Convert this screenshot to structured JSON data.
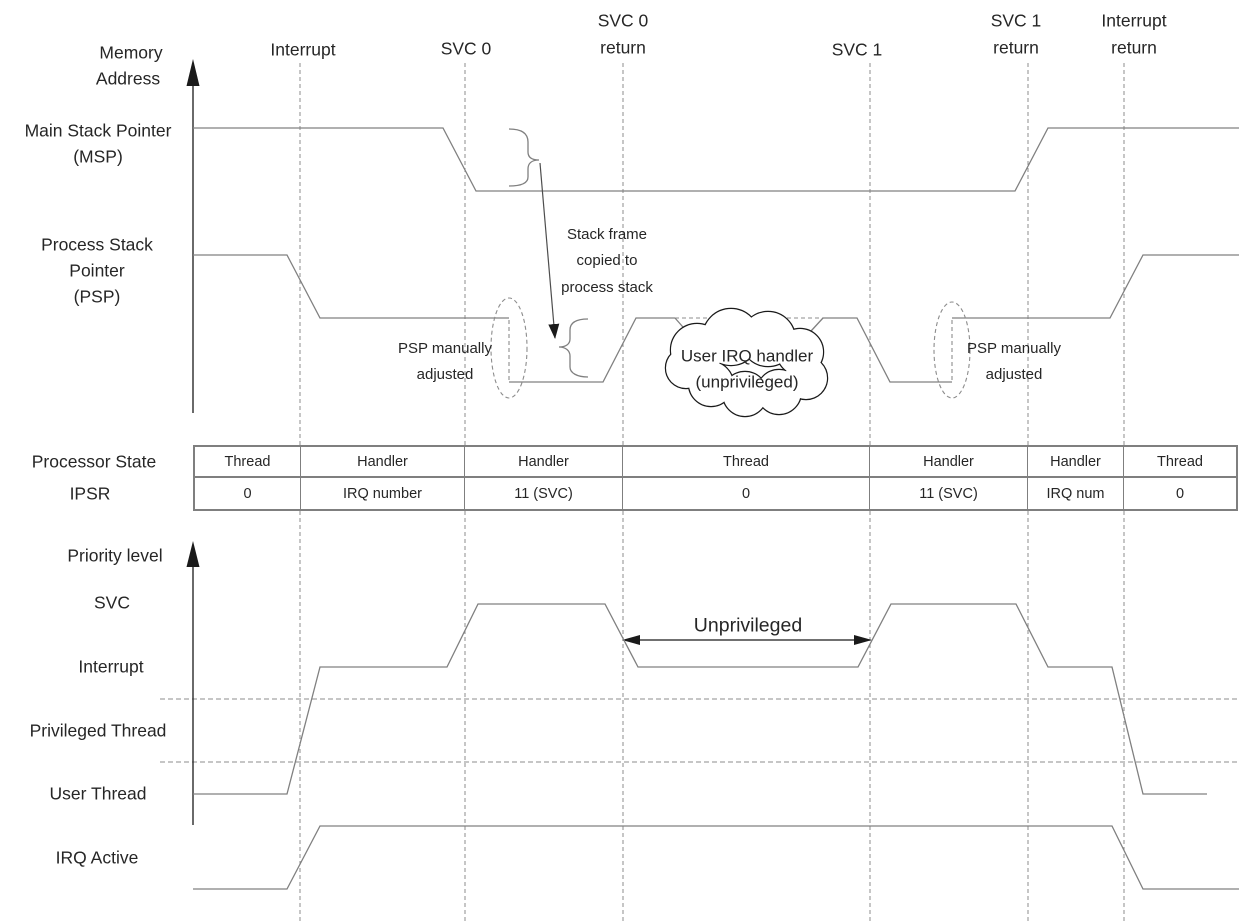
{
  "memory_section": {
    "axis_label_line1": "Memory",
    "axis_label_line2": "Address",
    "msp_label_line1": "Main Stack Pointer",
    "msp_label_line2": "(MSP)",
    "psp_label_line1": "Process Stack",
    "psp_label_line2": "Pointer",
    "psp_label_line3": "(PSP)"
  },
  "events": {
    "interrupt": "Interrupt",
    "svc0": "SVC 0",
    "svc0_return_line1": "SVC 0",
    "svc0_return_line2": "return",
    "svc1": "SVC 1",
    "svc1_return_line1": "SVC 1",
    "svc1_return_line2": "return",
    "interrupt_return_line1": "Interrupt",
    "interrupt_return_line2": "return"
  },
  "annotations": {
    "stack_frame_line1": "Stack frame",
    "stack_frame_line2": "copied to",
    "stack_frame_line3": "process stack",
    "psp_adjusted_left_line1": "PSP manually",
    "psp_adjusted_left_line2": "adjusted",
    "psp_adjusted_right_line1": "PSP manually",
    "psp_adjusted_right_line2": "adjusted",
    "cloud_line1": "User IRQ handler",
    "cloud_line2": "(unprivileged)",
    "unprivileged": "Unprivileged"
  },
  "state_table": {
    "row1_label": "Processor State",
    "row2_label": "IPSR",
    "state_cells": [
      "Thread",
      "Handler",
      "Handler",
      "Thread",
      "Handler",
      "Handler",
      "Thread"
    ],
    "ipsr_cells": [
      "0",
      "IRQ number",
      "11 (SVC)",
      "0",
      "11 (SVC)",
      "IRQ num",
      "0"
    ]
  },
  "priority_section": {
    "axis_label": "Priority level",
    "level_svc": "SVC",
    "level_interrupt": "Interrupt",
    "level_privileged": "Privileged Thread",
    "level_user": "User Thread",
    "level_irq": "IRQ Active"
  },
  "colors": {
    "trace_gray": "#808080",
    "dashed_gray": "#8c8c8c",
    "text": "#262626",
    "arrow_black": "#1a1a1a"
  }
}
